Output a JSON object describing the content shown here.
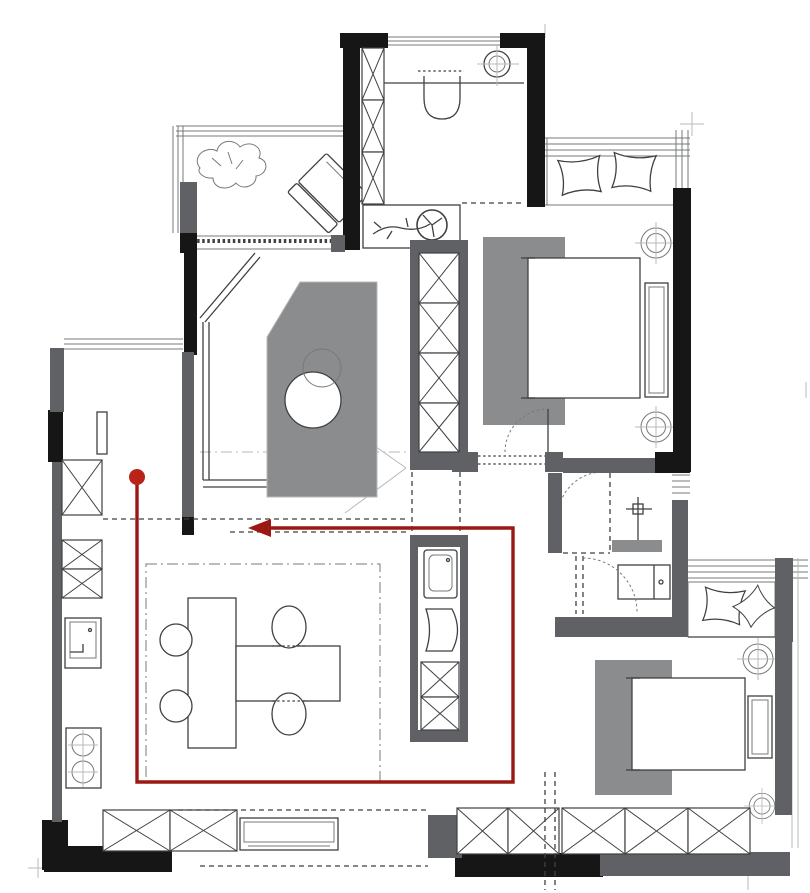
{
  "colors": {
    "paper": "#ffffff",
    "wall-black": "#161616",
    "wall-gray": "#5f6164",
    "furniture-gray": "#8b8c8e",
    "line-dark": "#3f4042",
    "line-mid": "#77787a",
    "line-light": "#b9b9b9",
    "route-red": "#9a1a13",
    "route-dot-red": "#b92318"
  },
  "route": {
    "points": "137,477 137,782 513,782 513,528 270,528",
    "arrow": "248,528 271,519 271,537",
    "dot": {
      "cx": "137",
      "cy": "477",
      "r": "8"
    }
  }
}
